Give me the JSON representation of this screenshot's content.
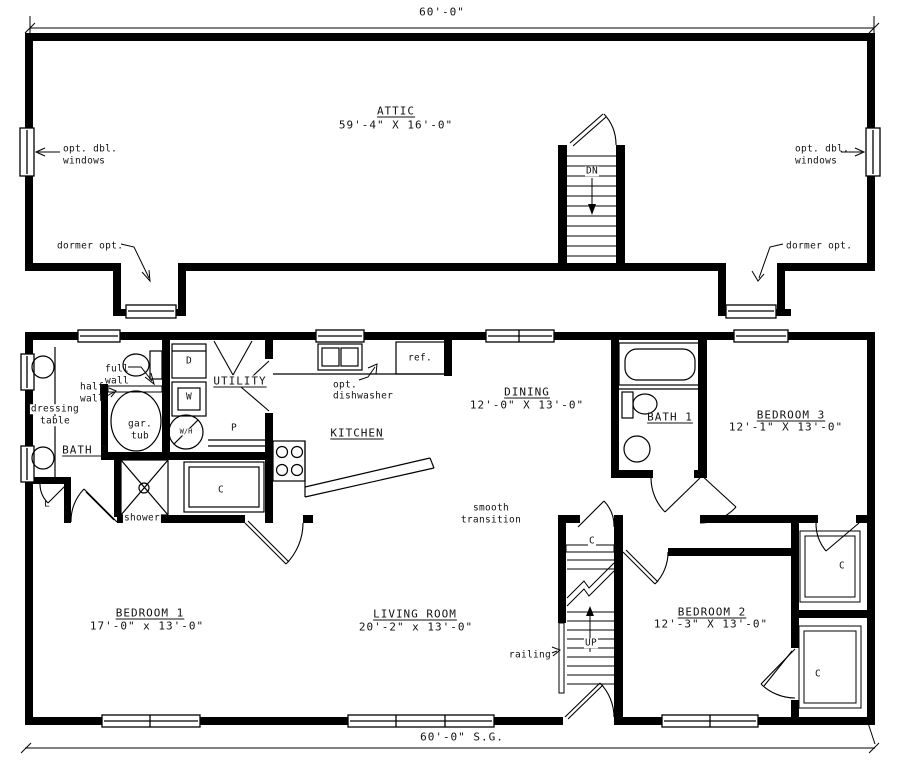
{
  "dimensions": {
    "overall_width_top": "60'-0\"",
    "overall_width_bottom": "60'-0\" S.G."
  },
  "attic": {
    "name": "ATTIC",
    "size": "59'-4\" X 16'-0\"",
    "stair_direction": "DN",
    "notes": {
      "windows_line1": "opt. dbl.",
      "windows_line2": "windows",
      "dormer": "dormer opt."
    }
  },
  "main": {
    "rooms": {
      "bath2": {
        "name": "BATH 2"
      },
      "bath1": {
        "name": "BATH 1"
      },
      "utility": {
        "name": "UTILITY"
      },
      "kitchen": {
        "name": "KITCHEN"
      },
      "dining": {
        "name": "DINING",
        "size": "12'-0\" X 13'-0\""
      },
      "bedroom1": {
        "name": "BEDROOM 1",
        "size": "17'-0\" x 13'-0\""
      },
      "bedroom2": {
        "name": "BEDROOM 2",
        "size": "12'-3\" X 13'-0\""
      },
      "bedroom3": {
        "name": "BEDROOM 3",
        "size": "12'-1\" X 13'-0\""
      },
      "living": {
        "name": "LIVING ROOM",
        "size": "20'-2\" x 13'-0\""
      }
    },
    "labels": {
      "dressing_line1": "dressing",
      "dressing_line2": "table",
      "full_line1": "full",
      "full_line2": "wall",
      "half_line1": "half",
      "half_line2": "wall",
      "tub_line1": "gar.",
      "tub_line2": "tub",
      "shower": "shower",
      "linen": "L",
      "dryer": "D",
      "washer": "W",
      "water_heater": "W/H",
      "pantry": "P",
      "closet": "C",
      "refrigerator": "ref.",
      "dishwasher_line1": "opt.",
      "dishwasher_line2": "dishwasher",
      "transition_line1": "smooth",
      "transition_line2": "transition",
      "railing": "railing",
      "stair_direction": "UP"
    }
  },
  "colors": {
    "ink": "#000000",
    "paper": "#ffffff"
  }
}
